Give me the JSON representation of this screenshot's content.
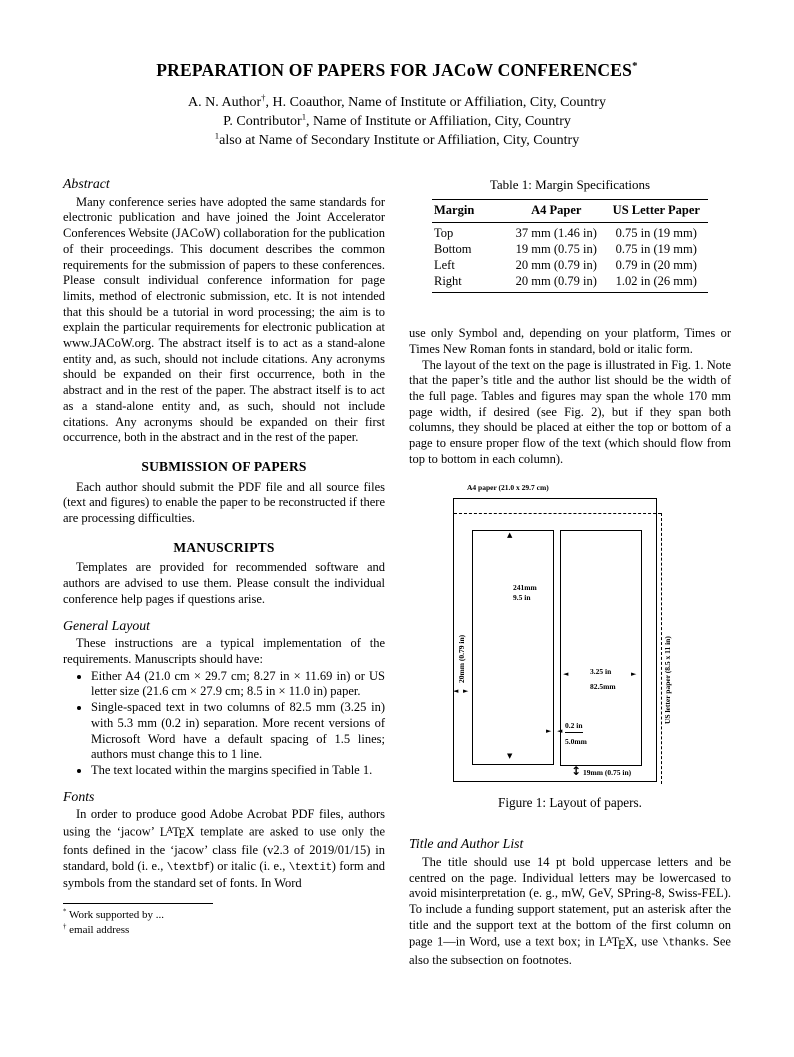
{
  "paper": {
    "title_segments": [
      {
        "t": "PREPARATION OF PAPERS FOR JACoW CONFERENCES"
      },
      {
        "t": "*",
        "sup": true
      }
    ],
    "author_lines": [
      [
        {
          "t": "A. N. Author"
        },
        {
          "t": "†",
          "sup": true
        },
        {
          "t": ", H. Coauthor, Name of Institute or Affiliation, City, Country"
        }
      ],
      [
        {
          "t": "P. Contributor"
        },
        {
          "t": "1",
          "sup": true
        },
        {
          "t": ", Name of Institute or Affiliation, City, Country"
        }
      ],
      [
        {
          "t": "1",
          "sup": true
        },
        {
          "t": "also at Name of Secondary Institute or Affiliation, City, Country"
        }
      ]
    ]
  },
  "latex_logo": "LATEX",
  "left_column": {
    "abstract_heading": "Abstract",
    "abstract_text": "Many conference series have adopted the same standards for electronic publication and have joined the Joint Accelerator Conferences Website (JACoW) collaboration for the publication of their proceedings. This document describes the common requirements for the submission of papers to these conferences. Please consult individual conference information for page limits, method of electronic submission, etc. It is not intended that this should be a tutorial in word processing; the aim is to explain the particular requirements for electronic publication at www.JACoW.org. The abstract itself is to act as a stand-alone entity and, as such, should not include citations. Any acronyms should be expanded on their first occurrence, both in the abstract and in the rest of the paper. The abstract itself is to act as a stand-alone entity and, as such, should not include citations. Any acronyms should be expanded on their first occurrence, both in the abstract and in the rest of the paper.",
    "submission_heading": "SUBMISSION OF PAPERS",
    "submission_text": "Each author should submit the PDF file and all source files (text and figures) to enable the paper to be reconstructed if there are processing difficulties.",
    "manuscripts_heading": "MANUSCRIPTS",
    "manuscripts_text": "Templates are provided for recommended software and authors are advised to use them. Please consult the individual conference help pages if questions arise.",
    "general_layout_heading": "General Layout",
    "general_layout_intro": "These instructions are a typical implementation of the requirements. Manuscripts should have:",
    "bullets": [
      "Either A4 (21.0 cm × 29.7 cm; 8.27 in × 11.69 in) or US letter size (21.6 cm × 27.9 cm; 8.5 in × 11.0 in) paper.",
      "Single-spaced text in two columns of 82.5 mm (3.25 in) with 5.3 mm (0.2 in) separation. More recent versions of Microsoft Word have a default spacing of 1.5 lines; authors must change this to 1 line.",
      "The text located within the margins specified in Table 1."
    ],
    "fonts_heading": "Fonts",
    "fonts_paragraph": [
      {
        "t": "In order to produce good Adobe Acrobat PDF files, authors using the ‘jacow’ "
      },
      {
        "latex": true
      },
      {
        "t": " template are asked to use only the fonts defined in the ‘jacow’ class file (v2.3 of 2019/01/15) in standard, bold (i. e., "
      },
      {
        "t": "\\textbf",
        "mono": true
      },
      {
        "t": ") or italic (i. e., "
      },
      {
        "t": "\\textit",
        "mono": true
      },
      {
        "t": ") form and symbols from the standard set of fonts. In Word"
      }
    ],
    "footnotes": [
      [
        {
          "t": "*",
          "sup": true
        },
        {
          "t": " Work supported by ..."
        }
      ],
      [
        {
          "t": "†",
          "sup": true
        },
        {
          "t": " email address"
        }
      ]
    ]
  },
  "table1": {
    "caption": "Table 1: Margin Specifications",
    "headers": [
      "Margin",
      "A4 Paper",
      "US Letter Paper"
    ],
    "rows": [
      [
        "Top",
        "37 mm (1.46 in)",
        "0.75 in (19 mm)"
      ],
      [
        "Bottom",
        "19 mm (0.75 in)",
        "0.75 in (19 mm)"
      ],
      [
        "Left",
        "20 mm (0.79 in)",
        "0.79 in (20 mm)"
      ],
      [
        "Right",
        "20 mm (0.79 in)",
        "1.02 in (26 mm)"
      ]
    ]
  },
  "right_column": {
    "para_fonts_continued": "use only Symbol and, depending on your platform, Times or Times New Roman fonts in standard, bold or italic form.",
    "para_layout": "The layout of the text on the page is illustrated in Fig. 1. Note that the paper’s title and the author list should be the width of the full page. Tables and figures may span the whole 170 mm page width, if desired (see Fig. 2), but if they span both columns, they should be placed at either the top or bottom of a page to ensure proper flow of the text (which should flow from top to bottom in each column).",
    "title_author_heading": "Title and Author List",
    "title_author_paragraph": [
      {
        "t": "The title should use 14 pt bold uppercase letters and be centred on the page. Individual letters may be lowercased to avoid misinterpretation (e. g., mW, GeV, SPring-8, Swiss-FEL). To include a funding support statement, put an asterisk after the title and the support text at the bottom of the first column on page 1—in Word, use a text box; in "
      },
      {
        "latex": true
      },
      {
        "t": ", use "
      },
      {
        "t": "\\thanks",
        "mono": true
      },
      {
        "t": ". See also the subsection on footnotes."
      }
    ]
  },
  "figure1": {
    "a4_label": "A4 paper (21.0 x 29.7 cm)",
    "us_letter_label": "US letter paper (8.5 x 11 in)",
    "col_height_mm": "241mm",
    "col_height_in": "9.5 in",
    "left_margin_label": "20mm (0.79 in)",
    "col_width_in": "3.25 in",
    "col_width_mm": "82.5mm",
    "gap_in": "0.2 in",
    "gap_mm": "5.0mm",
    "bottom_margin_label": "19mm (0.75 in)",
    "caption": "Figure 1: Layout of papers.",
    "icons": {
      "up": "▲",
      "down": "▼",
      "left": "◄",
      "right": "►",
      "updown": "↕"
    }
  }
}
